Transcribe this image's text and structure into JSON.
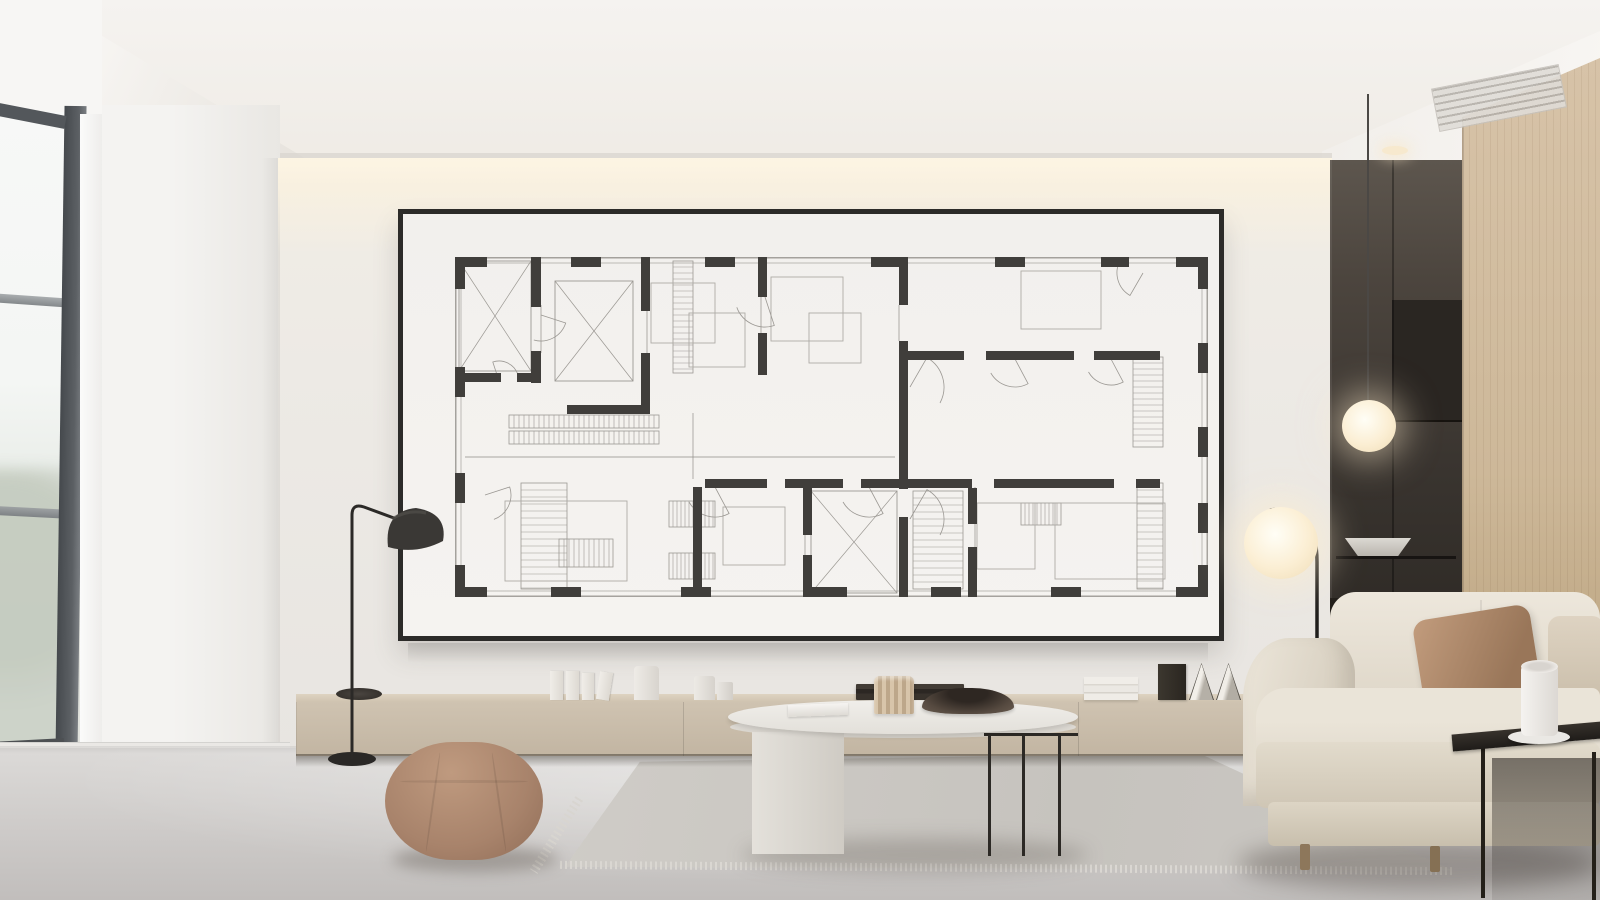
{
  "meta": {
    "description": "Photoreal render of a minimalist living room: a large black-framed architectural floor plan poster hangs on a warm white feature wall lit by a ceiling light cove; below it a long light-oak credenza with decor objects; cream sofa, oval coffee table, round taupe pouf, gray rug, two floor lamps, a pendant globe lamp over a dark kitchen niche, light oak wall panel, and a tall window on the left.",
    "width_px": 1600,
    "height_px": 900
  },
  "palette": {
    "wall": "#edeae5",
    "cove_glow": "#fdf5e3",
    "ceiling": "#f4f2ef",
    "floor": "#cdcac8",
    "frame_black": "#2c2b29",
    "poster_white": "#f3f1ee",
    "plan_ink": "#403e3b",
    "credenza_wood": "#c9bcaa",
    "panel_wood": "#d2bda1",
    "sofa_fabric": "#e5ded1",
    "pillow_tan": "#ab8767",
    "pouf": "#ad876e",
    "rug": "#cac7c2",
    "niche_dark": "#3a3530",
    "lamp_glow": "#fbeed3",
    "window_frame": "#53575b"
  },
  "scene": {
    "objects": [
      {
        "name": "window",
        "desc": "tall dark-framed window, bright overcast light, blurred foliage below",
        "color": "#53575b"
      },
      {
        "name": "cove-light",
        "desc": "warm linear LED cove washing the feature wall",
        "color": "#fdf5e3"
      },
      {
        "name": "artwork",
        "desc": "large framed black-and-white architectural floor plan",
        "color": "#2c2b29"
      },
      {
        "name": "credenza",
        "desc": "long low light-oak media console",
        "color": "#c9bcaa"
      },
      {
        "name": "credenza-decor",
        "desc": "white books, white vases and jars, dark tray stack, white book pile, dark frame, two cone objects, dark disc tray",
        "color": "#efece7"
      },
      {
        "name": "dome-floor-lamp",
        "desc": "black floor reading lamp with dome shade",
        "color": "#2b2927"
      },
      {
        "name": "pouf",
        "desc": "round taupe upholstered ottoman",
        "color": "#ad876e"
      },
      {
        "name": "rug",
        "desc": "light gray fringed area rug",
        "color": "#cac7c2"
      },
      {
        "name": "coffee-table",
        "desc": "white oval table, slab leg left, thin black metal legs right; notebook, fluted beige vase, dark bowl on top",
        "color": "#eceae6"
      },
      {
        "name": "arc-floor-lamp",
        "desc": "black arc lamp with glowing opal globe",
        "color": "#fbeed3"
      },
      {
        "name": "sofa",
        "desc": "cream channel-stitched fabric sofa with tan and beige pillows",
        "color": "#e5ded1"
      },
      {
        "name": "side-table",
        "desc": "thin black metal side table with white mug on saucer",
        "color": "#23201d"
      },
      {
        "name": "kitchen-niche",
        "desc": "dark recessed kitchenette with shelf and white bowl",
        "color": "#3a3530"
      },
      {
        "name": "pendant-lamp",
        "desc": "thin-cord pendant with glowing opal globe",
        "color": "#fbeed3"
      },
      {
        "name": "wood-panel",
        "desc": "light oak wall panel column",
        "color": "#d2bda1"
      },
      {
        "name": "ceiling-vent",
        "desc": "linear slot diffuser in white soffit",
        "color": "#b4b0aa"
      }
    ]
  },
  "plan": {
    "w": 753,
    "h": 340,
    "colors": {
      "wall": "#403e3b",
      "line": "#918e89",
      "furn": "#aeaba6",
      "hatch": "#9b9893",
      "x": "#9b9893"
    },
    "walls": [
      [
        0,
        0,
        32,
        10
      ],
      [
        0,
        0,
        10,
        32
      ],
      [
        721,
        0,
        32,
        10
      ],
      [
        743,
        0,
        10,
        32
      ],
      [
        0,
        330,
        32,
        10
      ],
      [
        0,
        308,
        10,
        32
      ],
      [
        721,
        330,
        32,
        10
      ],
      [
        743,
        308,
        10,
        32
      ],
      [
        116,
        0,
        30,
        10
      ],
      [
        250,
        0,
        30,
        10
      ],
      [
        416,
        0,
        36,
        10
      ],
      [
        540,
        0,
        30,
        10
      ],
      [
        646,
        0,
        28,
        10
      ],
      [
        0,
        110,
        10,
        30
      ],
      [
        0,
        216,
        10,
        30
      ],
      [
        743,
        86,
        10,
        30
      ],
      [
        743,
        170,
        10,
        30
      ],
      [
        743,
        246,
        10,
        30
      ],
      [
        96,
        330,
        30,
        10
      ],
      [
        226,
        330,
        30,
        10
      ],
      [
        356,
        330,
        36,
        10
      ],
      [
        476,
        330,
        30,
        10
      ],
      [
        596,
        330,
        30,
        10
      ],
      [
        76,
        0,
        10,
        50
      ],
      [
        76,
        94,
        10,
        32
      ],
      [
        0,
        116,
        46,
        9
      ],
      [
        62,
        116,
        24,
        9
      ],
      [
        186,
        0,
        9,
        54
      ],
      [
        186,
        96,
        9,
        61
      ],
      [
        112,
        148,
        83,
        9
      ],
      [
        303,
        0,
        9,
        40
      ],
      [
        303,
        76,
        9,
        42
      ],
      [
        444,
        0,
        9,
        48
      ],
      [
        444,
        84,
        9,
        148
      ],
      [
        444,
        260,
        9,
        80
      ],
      [
        453,
        94,
        56,
        9
      ],
      [
        531,
        94,
        88,
        9
      ],
      [
        639,
        94,
        66,
        9
      ],
      [
        453,
        222,
        64,
        9
      ],
      [
        539,
        222,
        120,
        9
      ],
      [
        681,
        222,
        24,
        9
      ],
      [
        513,
        231,
        9,
        36
      ],
      [
        513,
        290,
        9,
        50
      ],
      [
        238,
        230,
        9,
        110
      ],
      [
        348,
        230,
        9,
        48
      ],
      [
        348,
        298,
        9,
        42
      ],
      [
        250,
        222,
        62,
        9
      ],
      [
        330,
        222,
        58,
        9
      ],
      [
        406,
        222,
        38,
        9
      ]
    ],
    "xboxes": [
      [
        4,
        4,
        72,
        110
      ],
      [
        100,
        24,
        78,
        100
      ],
      [
        356,
        234,
        86,
        102
      ]
    ],
    "hatch_v": [
      [
        218,
        4,
        20,
        112,
        6
      ],
      [
        678,
        100,
        30,
        90,
        6
      ],
      [
        682,
        226,
        26,
        106,
        7
      ],
      [
        66,
        226,
        46,
        106,
        7
      ],
      [
        458,
        234,
        50,
        98,
        7
      ]
    ],
    "hatch_h": [
      [
        54,
        158,
        150,
        13,
        5
      ],
      [
        54,
        174,
        150,
        13,
        5
      ],
      [
        214,
        244,
        46,
        26,
        4
      ],
      [
        214,
        296,
        46,
        26,
        4
      ],
      [
        104,
        282,
        54,
        28,
        5
      ],
      [
        566,
        246,
        40,
        22,
        4
      ]
    ],
    "furn": [
      [
        196,
        26,
        64,
        60
      ],
      [
        234,
        56,
        56,
        54
      ],
      [
        316,
        20,
        72,
        64
      ],
      [
        354,
        56,
        52,
        50
      ],
      [
        566,
        14,
        80,
        58
      ],
      [
        600,
        246,
        110,
        76
      ],
      [
        50,
        244,
        122,
        80
      ],
      [
        268,
        250,
        62,
        58
      ],
      [
        522,
        246,
        58,
        66
      ]
    ],
    "arcs": [
      [
        86,
        58,
        26,
        18
      ],
      [
        44,
        124,
        20,
        252
      ],
      [
        310,
        40,
        30,
        72
      ],
      [
        455,
        130,
        34,
        300
      ],
      [
        455,
        262,
        34,
        300
      ],
      [
        560,
        102,
        28,
        62
      ],
      [
        656,
        102,
        26,
        62
      ],
      [
        260,
        230,
        30,
        62
      ],
      [
        414,
        230,
        30,
        62
      ],
      [
        30,
        238,
        26,
        342
      ],
      [
        688,
        16,
        26,
        120
      ]
    ],
    "lines": [
      [
        10,
        200,
        440,
        200
      ],
      [
        238,
        156,
        238,
        222
      ],
      [
        86,
        48,
        86,
        96
      ],
      [
        192,
        54,
        192,
        96
      ],
      [
        306,
        40,
        306,
        76
      ],
      [
        520,
        230,
        520,
        290
      ],
      [
        350,
        276,
        350,
        298
      ],
      [
        444,
        48,
        444,
        84
      ]
    ]
  }
}
